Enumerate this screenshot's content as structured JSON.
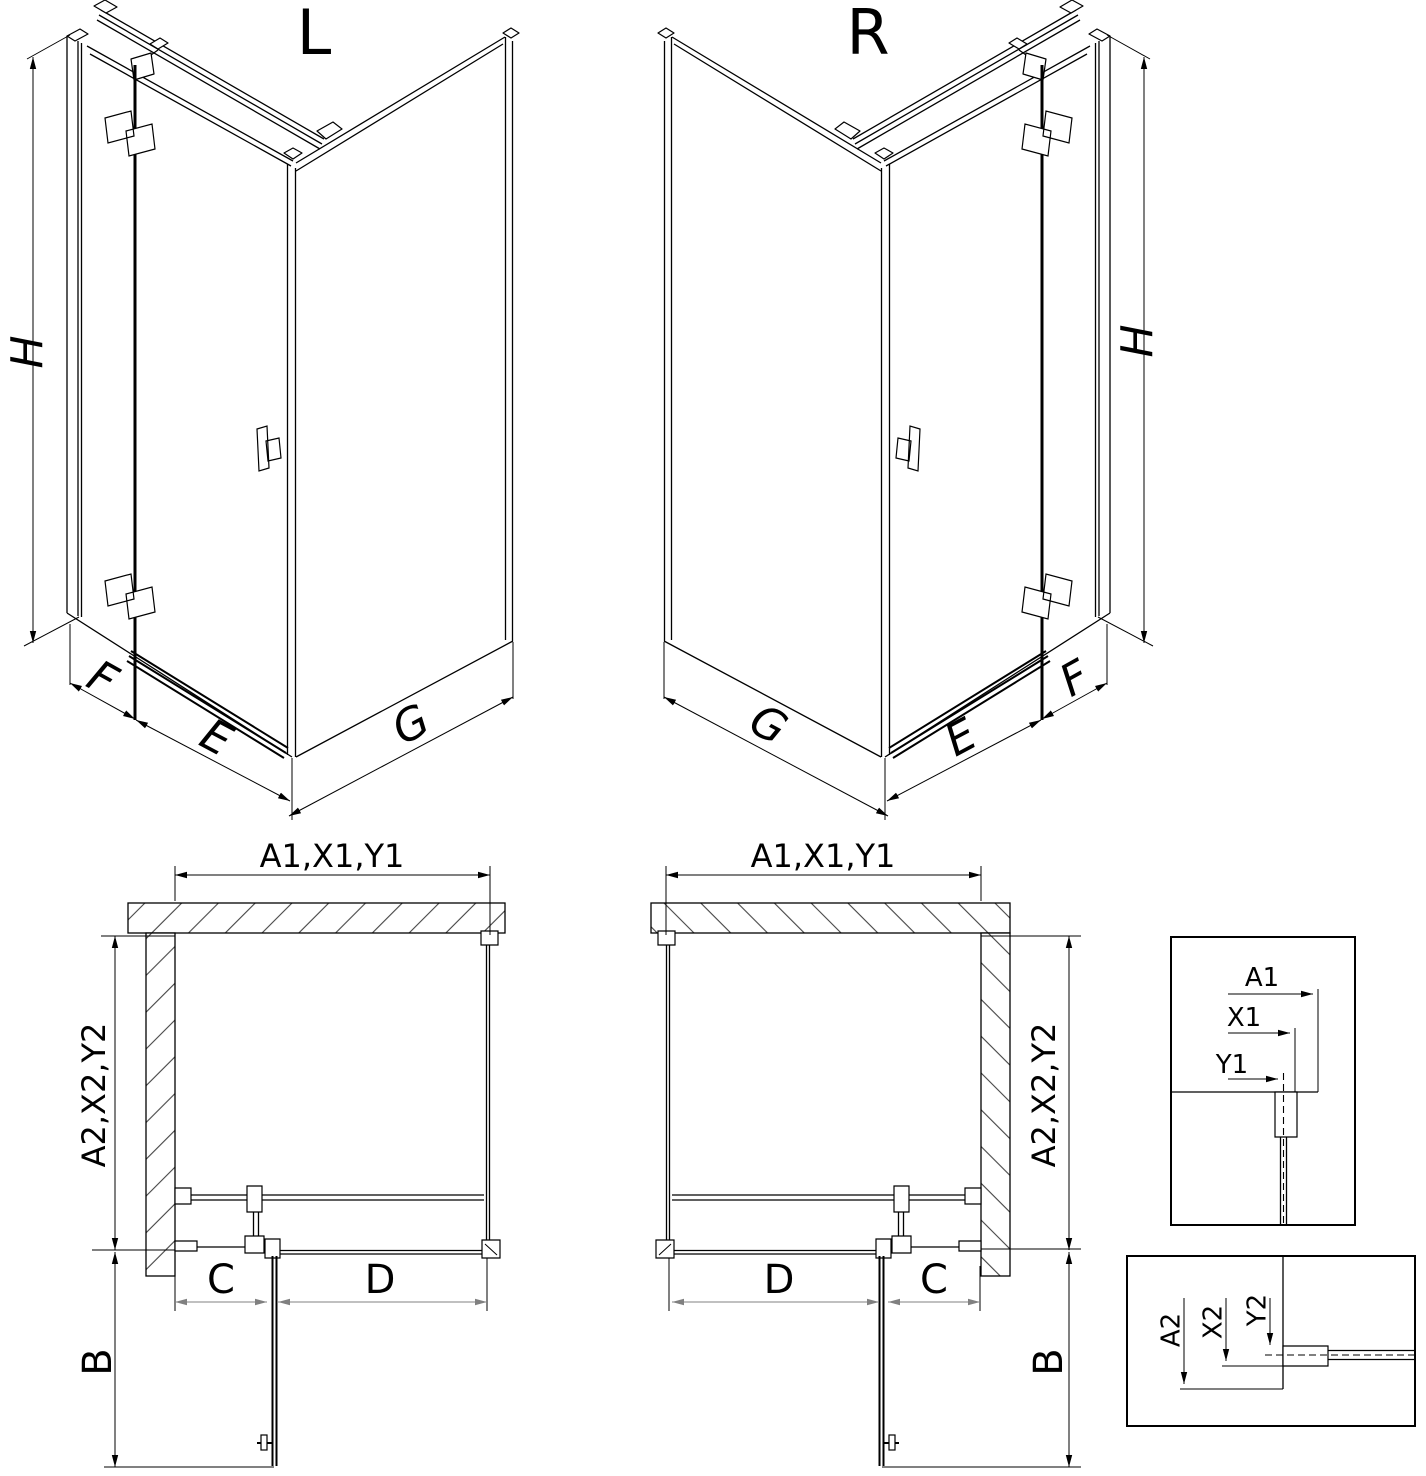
{
  "iso": {
    "left": {
      "title": "L",
      "height_label": "H",
      "fixed_panel_label": "F",
      "door_width_label": "E",
      "side_panel_label": "G"
    },
    "right": {
      "title": "R",
      "height_label": "H",
      "fixed_panel_label": "F",
      "door_width_label": "E",
      "side_panel_label": "G"
    }
  },
  "plan": {
    "left": {
      "width_dims": "A1,X1,Y1",
      "depth_dims": "A2,X2,Y2",
      "door_swing_label": "B",
      "wall_to_hinge_label": "C",
      "hinge_to_corner_label": "D"
    },
    "right": {
      "width_dims": "A1,X1,Y1",
      "depth_dims": "A2,X2,Y2",
      "door_swing_label": "B",
      "wall_to_hinge_label": "C",
      "hinge_to_corner_label": "D"
    }
  },
  "details": {
    "width_section": {
      "total": "A1",
      "glass_outer": "X1",
      "glass_center": "Y1"
    },
    "depth_section": {
      "total": "A2",
      "glass_outer": "X2",
      "glass_center": "Y2"
    }
  },
  "colors": {
    "line": "#000000",
    "dim_secondary": "#808080",
    "background": "#ffffff"
  }
}
